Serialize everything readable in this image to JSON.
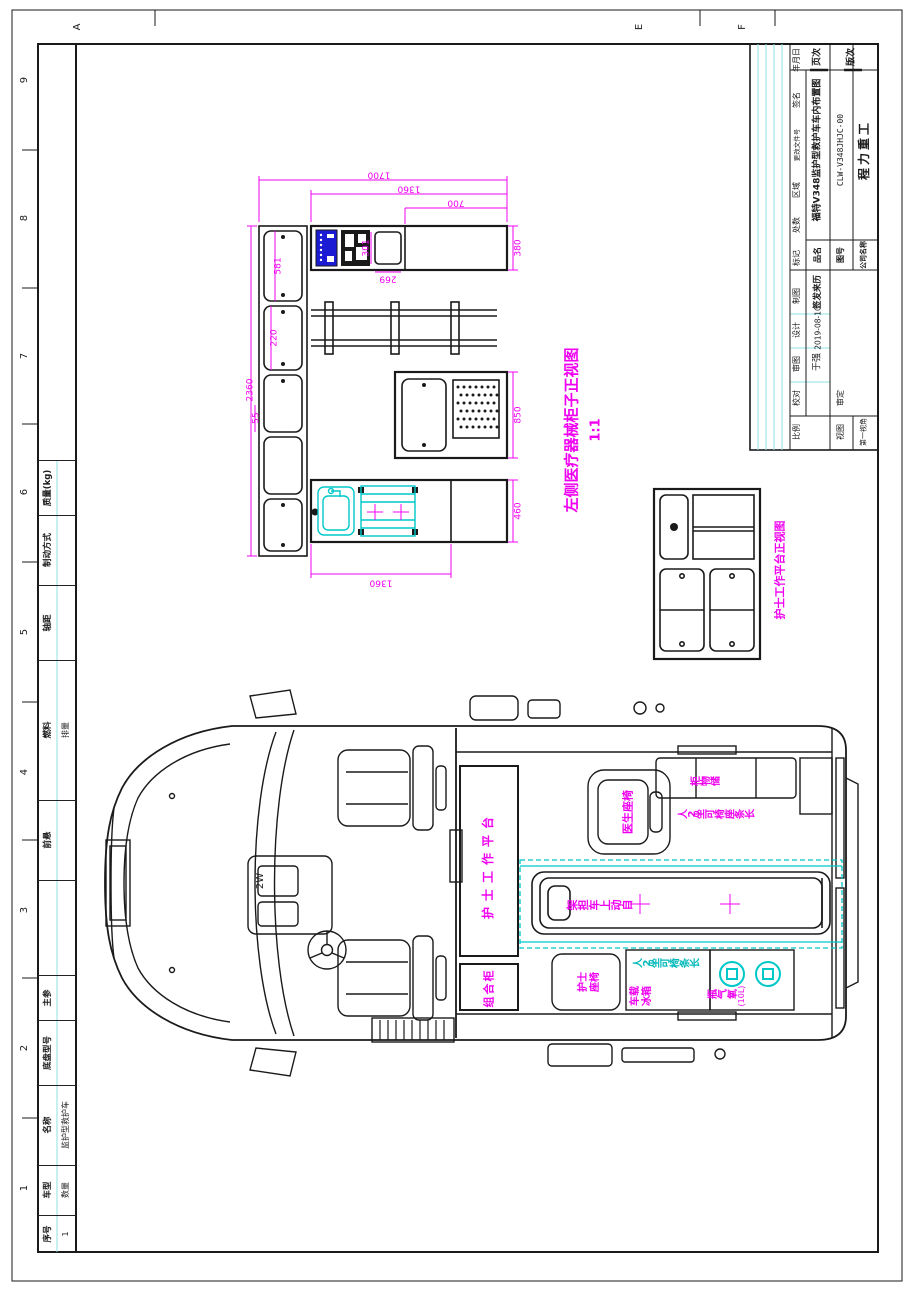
{
  "colors": {
    "magenta": "#f000f0",
    "cyan": "#00c8c8",
    "panel_blue": "#1b1bd4",
    "line_black": "#1a1a1a"
  },
  "sheet": {
    "row_refs": [
      "9",
      "8",
      "7",
      "6",
      "5",
      "4",
      "3",
      "2",
      "1"
    ],
    "col_refs": [
      "A",
      "E",
      "F"
    ]
  },
  "spec_table": {
    "rows": [
      {
        "label": "",
        "value": ""
      },
      {
        "label": "质量(kg)",
        "value": ""
      },
      {
        "label": "制动方式",
        "value": ""
      },
      {
        "label": "轴距",
        "value": ""
      },
      {
        "label": "燃料",
        "value": "排量"
      },
      {
        "label": "前悬",
        "value": ""
      },
      {
        "label": "",
        "value": ""
      },
      {
        "label": "主参",
        "value": ""
      },
      {
        "label": "底盘型号",
        "value": ""
      },
      {
        "label": "名称",
        "value": "监护型救护车"
      },
      {
        "label": "车型",
        "value": "数量"
      },
      {
        "label": "序号",
        "value": "1"
      }
    ]
  },
  "title_block": {
    "page_label": "页次",
    "rev_label": "版次",
    "rev_headers": [
      "标记",
      "处数",
      "区域",
      "更改文件号",
      "签名",
      "年月日"
    ],
    "sign_title": "签发来历",
    "date": "2019-08-10",
    "designer": "于强",
    "product_name": "福特V348监护型救护车车内布置图",
    "drawing_no": "CLW-V348JHJC-00",
    "company": "程力重工",
    "name_label": "品名",
    "no_label": "图号",
    "company_label": "公司名称",
    "roles": [
      "制图",
      "设计",
      "审图",
      "校对",
      "审定"
    ],
    "scale_label": "比例",
    "view_label": "视图",
    "angle_label": "第一视角"
  },
  "cabinet_view": {
    "title": "左侧医疗器械柜子正视图",
    "scale": "1:1",
    "dims": {
      "top1": "1700",
      "top2": "1360",
      "top3": "700",
      "right1": "380",
      "right2": "850",
      "right3": "460",
      "left": "2360",
      "d581": "581",
      "d220": "220",
      "d55": "55",
      "d301": "301",
      "d269": "269",
      "bottom": "1360"
    }
  },
  "nurse_view": {
    "title": "护士工作平台正视图"
  },
  "vehicle": {
    "labels": {
      "nurse_platform": "护士工作平台",
      "combo_cabinet": "组合柜",
      "doctor_seat": "医生座椅",
      "storage_cabinet": "储物柜",
      "bench_long": "长条座椅可坐2人",
      "stretcher": "自动上车担架",
      "nurse_seat_1": "护士",
      "nurse_seat_2": "座椅",
      "fridge_1": "车载",
      "fridge_2": "冰箱",
      "bench_cyan": "长条椅可坐2人",
      "oxygen": "氧气瓶",
      "oxygen_cap": "(10L)",
      "gear": "2W"
    }
  }
}
